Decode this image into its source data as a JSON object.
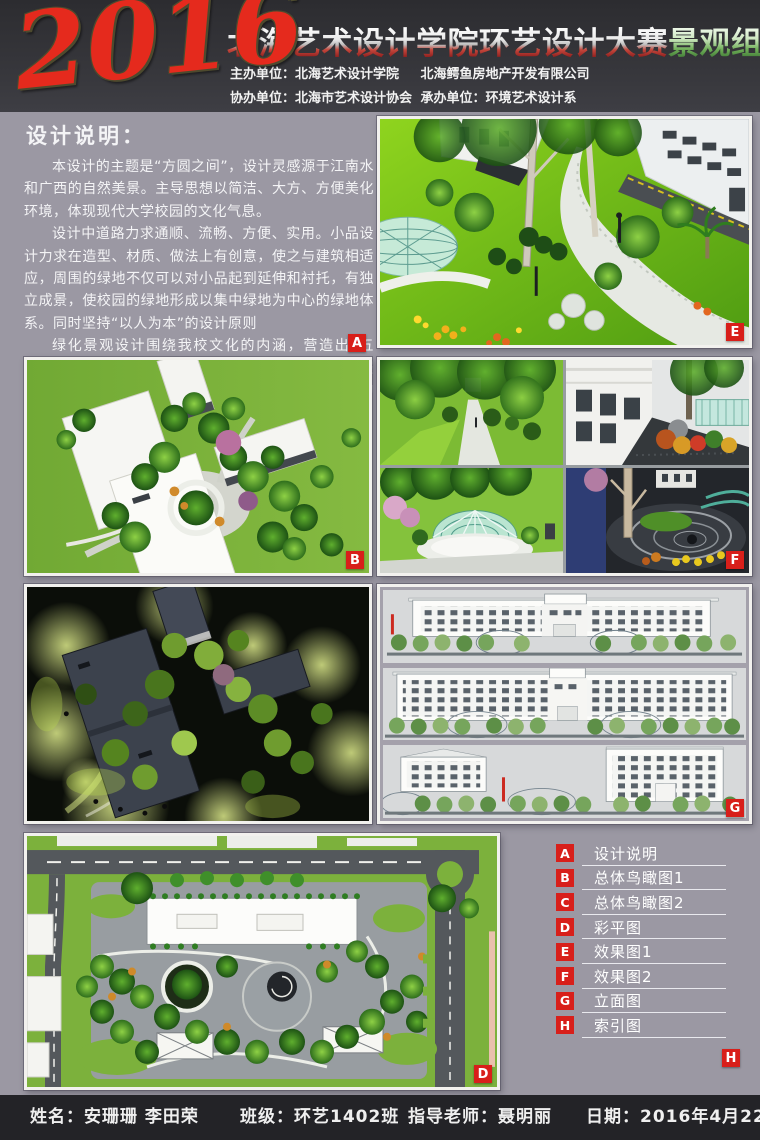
{
  "header": {
    "year": "2016",
    "title_main": "北海艺术设计学院环艺设计大赛",
    "title_group": "景观组",
    "org_line1_left": "主办单位：北海艺术设计学院",
    "org_line1_right": "北海鳄鱼房地产开发有限公司",
    "org_line2_left": "协办单位：北海市艺术设计协会",
    "org_line2_right": "承办单位：环境艺术设计系"
  },
  "description": {
    "title": "设计说明：",
    "paragraphs": [
      "本设计的主题是“方圆之间”，设计灵感源于江南水和广西的自然美景。主导思想以简洁、大方、方便美化环境，体现现代大学校园的文化气息。",
      "设计中道路力求通顺、流畅、方便、实用。小品设计力求在造型、材质、做法上有创意，使之与建筑相适应，周围的绿地不仅可以对小品起到延伸和衬托，有独立成景，使校园的绿地形成以集中绿地为中心的绿地体系。同时坚持“以人为本”的设计原则",
      "绿化景观设计围绕我校文化的内涵，营造出“五境”即品位高雅的文化环境，严谨开放的交流环境，催人奋进的学习环境，舒适宜人的休闲环境和和谐统一的生态环境。充分体现出北海艺术设计学院的景观特色"
    ]
  },
  "badges": {
    "notes": "A",
    "birdseye_day": "B",
    "site_plan": "D",
    "effect1": "E",
    "effect2": "F",
    "elevations": "G",
    "index": "H"
  },
  "legend": {
    "items": [
      {
        "letter": "A",
        "label": "设计说明"
      },
      {
        "letter": "B",
        "label": "总体鸟瞰图1"
      },
      {
        "letter": "C",
        "label": "总体鸟瞰图2"
      },
      {
        "letter": "D",
        "label": "彩平图"
      },
      {
        "letter": "E",
        "label": "效果图1"
      },
      {
        "letter": "F",
        "label": "效果图2"
      },
      {
        "letter": "G",
        "label": "立面图"
      },
      {
        "letter": "H",
        "label": "索引图"
      }
    ]
  },
  "footer": {
    "name_label": "姓名：",
    "name_value": "安珊珊 李田荣",
    "class_label": "班级：",
    "class_value": "环艺1402班",
    "teacher_label": "指导老师：",
    "teacher_value": "聂明丽",
    "date_label": "日期：",
    "date_value": "2016年4月22日"
  },
  "colors": {
    "accent_red": "#d81f1a",
    "page_background": "#9b98a3",
    "header_background": "#35353a",
    "footer_background": "#232327"
  }
}
